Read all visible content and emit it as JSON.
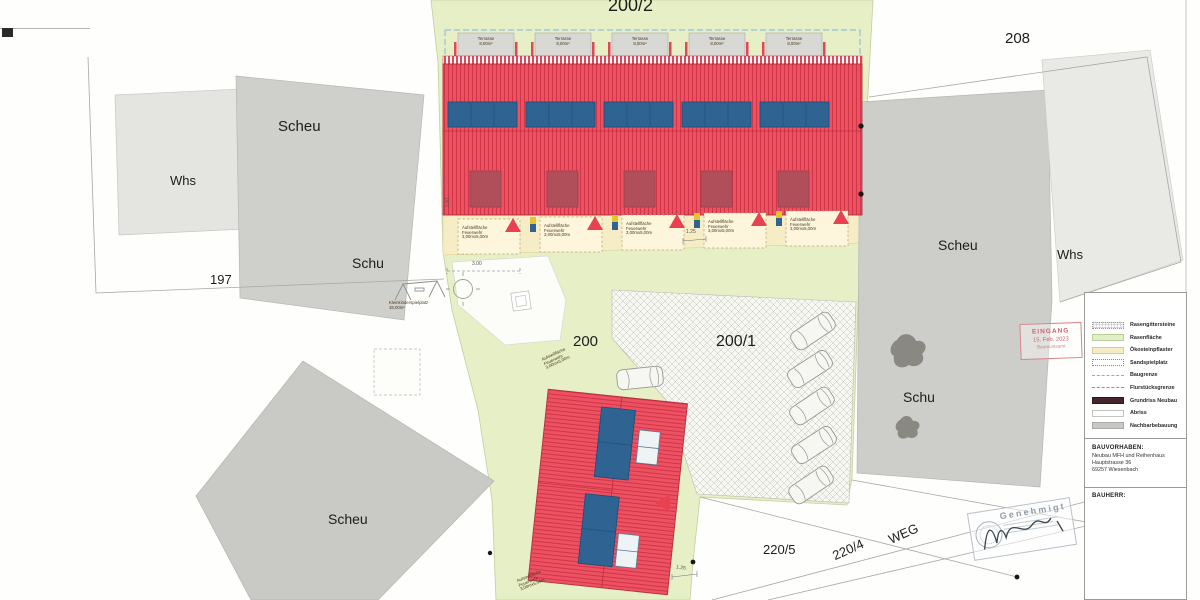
{
  "parcels": {
    "p200_2": "200/2",
    "p208": "208",
    "p197": "197",
    "p200": "200",
    "p200_1": "200/1",
    "p220_5": "220/5",
    "p220_4": "220/4"
  },
  "labels": {
    "scheu": "Scheu",
    "whs": "Whs",
    "schu": "Schu",
    "weg": "WEG"
  },
  "annotations": {
    "feuerwehr": "Aufstellfläche\nFeuerwehr\n3,00mx5,00m",
    "terrasse": "Terrasse\n8,00m²",
    "playground": "Kleinkinderspielplatz\n48,00m²"
  },
  "dimensions": {
    "d300": "3.00",
    "d125": "1.25"
  },
  "legend": {
    "items": [
      {
        "label": "Rasengittersteine",
        "type": "hatch"
      },
      {
        "label": "Rasenfläche",
        "type": "green"
      },
      {
        "label": "Ökosteinpflaster",
        "type": "yellow"
      },
      {
        "label": "Sandspielplatz",
        "type": "dotted"
      },
      {
        "label": "Baugrenze",
        "type": "dash-blue"
      },
      {
        "label": "Flurstücksgrenze",
        "type": "dash-gray"
      },
      {
        "label": "Grundriss Neubau",
        "type": "dark-red"
      },
      {
        "label": "Abriss",
        "type": "abriss"
      },
      {
        "label": "Nachbarbebauung",
        "type": "gray"
      }
    ]
  },
  "info": {
    "bauvorhaben_title": "BAUVORHABEN:",
    "line1": "Neubau MFH und Reihenhaus",
    "line2": "Hauptstrasse 36",
    "line3": "69257 Wiesenbach",
    "bauherr_title": "BAUHERR:"
  },
  "stamps": {
    "eingang": {
      "line1": "EINGANG",
      "line2": "15. Feb. 2023",
      "line3": "Baurechtsamt"
    },
    "genehmigt": {
      "title": "Genehmigt"
    }
  },
  "colors": {
    "lawn_green": "#e6efc5",
    "eco_paving_yellow": "#f6ecc6",
    "new_building_red": "#ed5263",
    "roof_hatch_red": "#d03648",
    "solar_blue": "#2f6391",
    "dormer_red": "#b04f59",
    "neighbor_gray": "#cccccb",
    "legend_darkred": "#46262b",
    "stamp_red": "#c9656c",
    "stamp_blue_gray": "#8f9ca8"
  }
}
